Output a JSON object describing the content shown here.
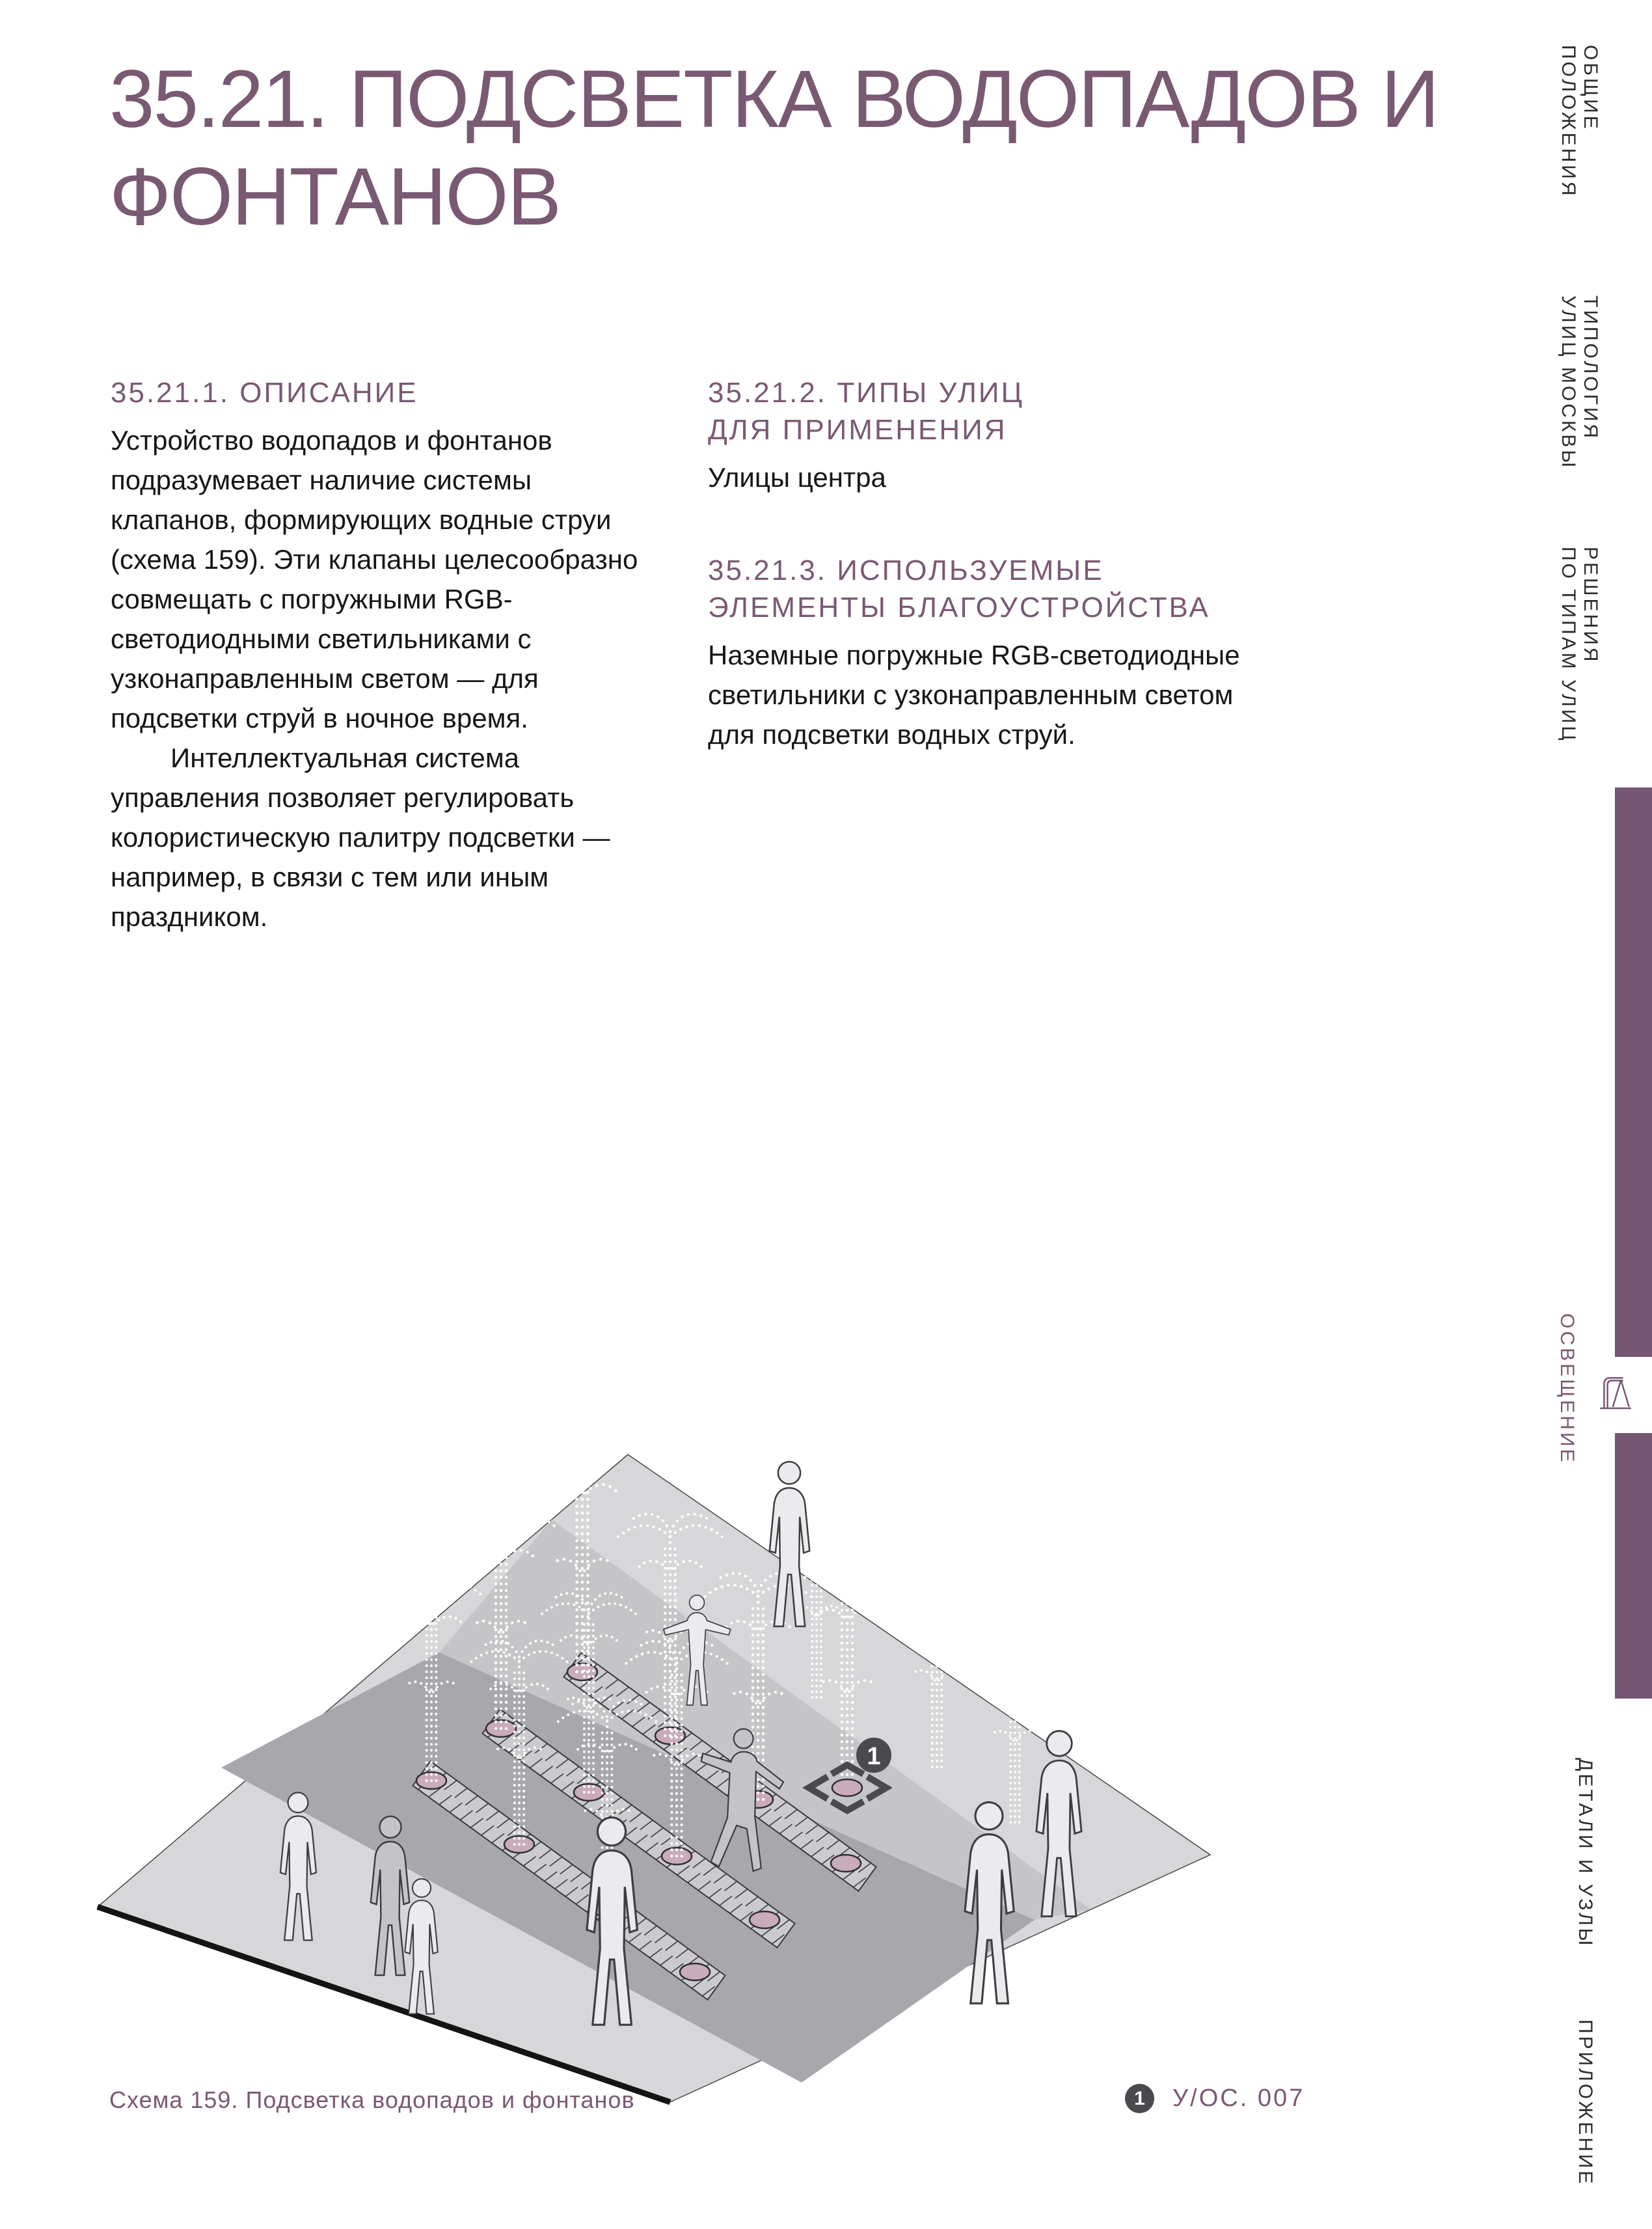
{
  "header": {
    "title": "35.21. ПОДСВЕТКА ВОДОПАДОВ И ФОНТАНОВ"
  },
  "sections": {
    "s1": {
      "title": "35.21.1. ОПИСАНИЕ",
      "p1": "Устройство водопадов и фонтанов подразумевает наличие системы клапанов, формирующих водные струи (схема 159). Эти клапаны целесообразно совмещать с погружными RGB-светодиодными светильниками с узконаправленным светом — для подсветки струй в ночное время.",
      "p2": "Интеллектуальная система управления позволяет регулировать колористическую палитру подсветки — например, в связи с тем или иным праздником."
    },
    "s2": {
      "title": "35.21.2. ТИПЫ УЛИЦ\nДЛЯ ПРИМЕНЕНИЯ",
      "body": "Улицы центра"
    },
    "s3": {
      "title": "35.21.3. ИСПОЛЬЗУЕМЫЕ\nЭЛЕМЕНТЫ БЛАГОУСТРОЙСТВА",
      "body": "Наземные погружные RGB-светодиодные светильники с узконаправленным светом для подсветки водных струй."
    }
  },
  "sidebar": {
    "items": [
      {
        "label": "ОБЩИЕ\nПОЛОЖЕНИЯ",
        "active": false
      },
      {
        "label": "ТИПОЛОГИЯ\nУЛИЦ МОСКВЫ",
        "active": false
      },
      {
        "label": "РЕШЕНИЯ\nПО ТИПАМ УЛИЦ",
        "active": false
      },
      {
        "label": "ОСВЕЩЕНИЕ",
        "active": true
      },
      {
        "label": "ДЕТАЛИ И УЗЛЫ",
        "active": false
      },
      {
        "label": "ПРИЛОЖЕНИЕ",
        "active": false
      }
    ],
    "active_icon": "street-lamp-icon"
  },
  "figure": {
    "caption": "Схема 159. Подсветка водопадов и фонтанов",
    "marker_label": "1",
    "content": "Изометрическая схема площади с линейными фонтанами, погружными RGB-светильниками и силуэтами людей"
  },
  "legend": {
    "marker": "1",
    "code": "У/ОС. 007"
  },
  "colors": {
    "accent_text": "#7a5973",
    "accent_bar": "#765672",
    "badge": "#4a4a4e",
    "plaza_light": "#d7d7d9",
    "plaza_medium": "#c5c5c8",
    "plaza_dark": "#a8a8ac",
    "strip": "#cbcbce",
    "nozzle_pink": "#c9abbc"
  }
}
